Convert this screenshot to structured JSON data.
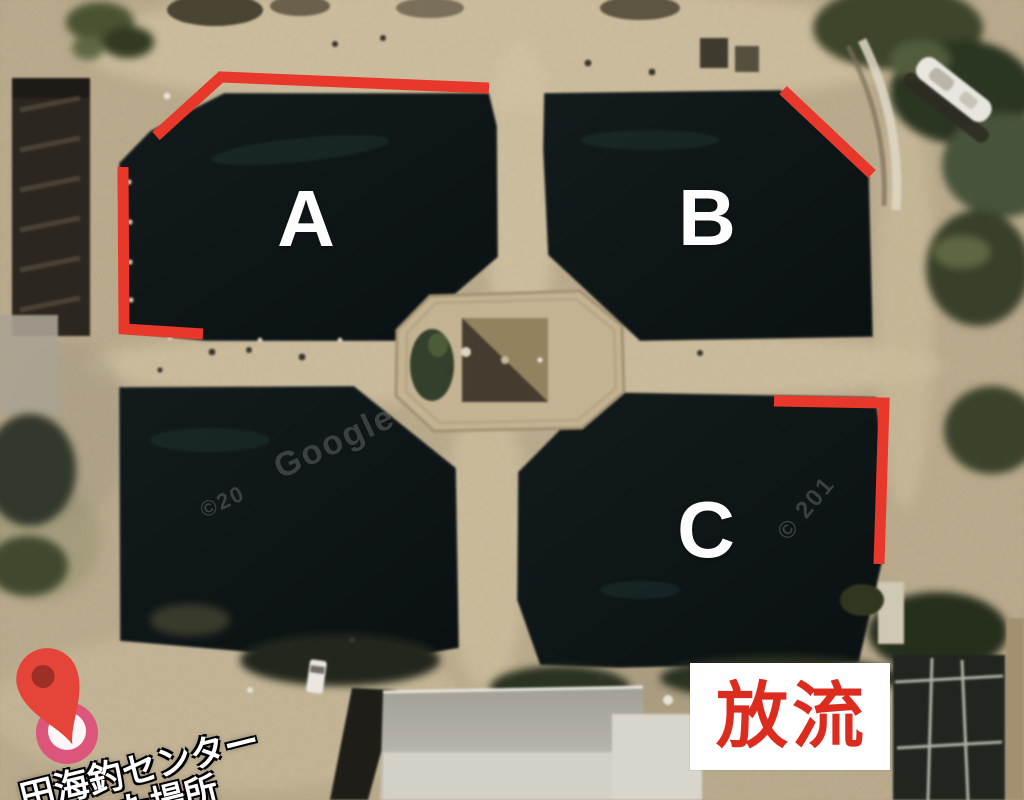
{
  "labels": {
    "a": "A",
    "b": "B",
    "c": "C"
  },
  "release_sign": {
    "text": "放流"
  },
  "place_marker": {
    "name_line": "田海釣センター",
    "sub_line": "た場所"
  },
  "watermarks": {
    "google": "Google",
    "copy_left": "©20",
    "copy_right": "© 201"
  },
  "colors": {
    "annotation-red": "#e8382b",
    "sign-red": "#dc2c20",
    "label-white": "#fdfdfd",
    "pin-red": "#e54538",
    "pin-hole": "#9e2f26",
    "pin-pink": "#dc567c"
  }
}
